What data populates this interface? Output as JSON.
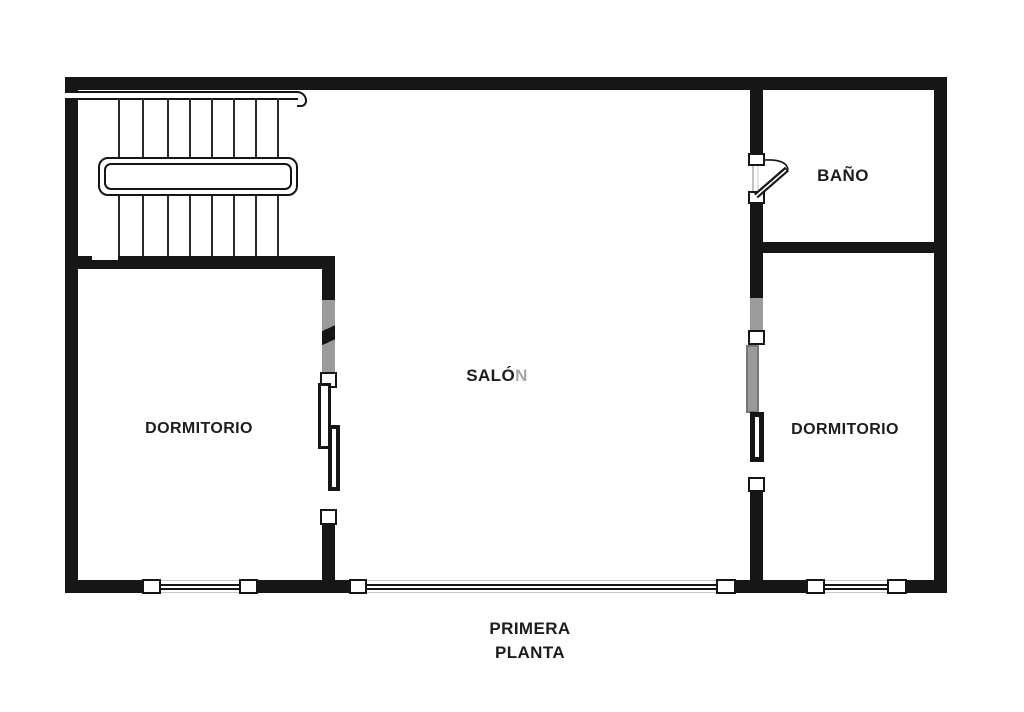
{
  "plan": {
    "rooms": {
      "bathroom": {
        "label": "BAÑO"
      },
      "living": {
        "label": "SALÓN",
        "label_dark": "SALÓ",
        "label_faded": "N"
      },
      "bedroom_left": {
        "label": "DORMITORIO"
      },
      "bedroom_right": {
        "label": "DORMITORIO"
      }
    },
    "caption": {
      "line1": "PRIMERA",
      "line2": "PLANTA"
    }
  },
  "colors": {
    "wall": "#161616",
    "label_text": "#1d1d1f",
    "faded_label": "#a6a6ac",
    "watermark_gray": "#9b9b9b"
  }
}
